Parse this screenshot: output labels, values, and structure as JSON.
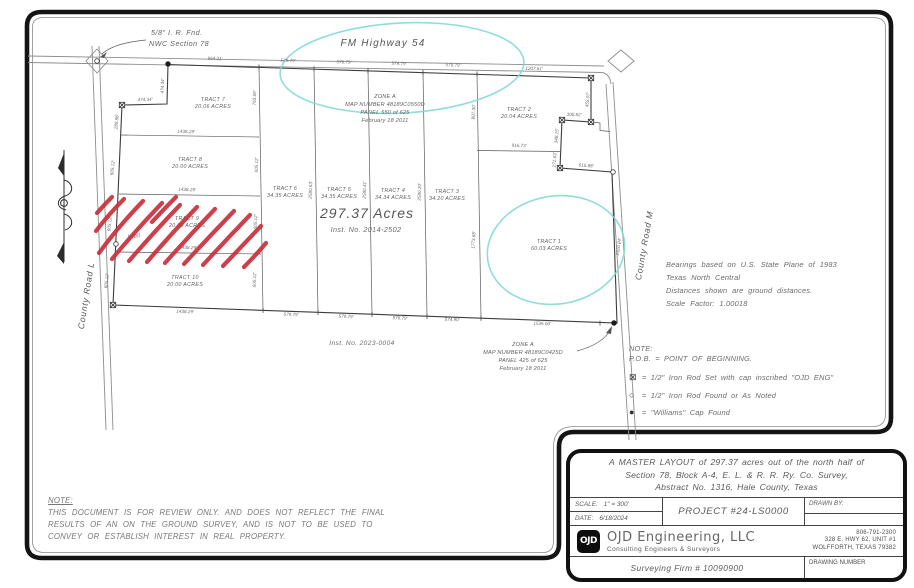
{
  "colors": {
    "linework": "#4a4a4a",
    "dim_text": "#6b6b6b",
    "hatch_red": "#c9303c",
    "highlight_cyan": "#7ed7d1",
    "frame_black": "#141414",
    "paper": "#ffffff"
  },
  "map": {
    "highway_label": "FM Highway 54",
    "corner_note": {
      "line1": "5/8\" I. R. Fnd.",
      "line2": "NWC Section 78"
    },
    "road_west": "County Road L",
    "road_east": "County Road M",
    "total_area": "297.37 Acres",
    "total_area_inst": "Inst. No. 2014-2502",
    "south_inst": "Inst. No. 2023-0004",
    "well_label": "Well",
    "zone_north": {
      "line1": "ZONE A",
      "line2": "MAP NUMBER 48189C0550D",
      "line3": "PANEL 550 of 625",
      "line4": "February 18 2011"
    },
    "zone_south": {
      "line1": "ZONE A",
      "line2": "MAP NUMBER 48189C0425D",
      "line3": "PANEL 425 of 625",
      "line4": "February 18 2011"
    },
    "tracts": [
      {
        "name": "TRACT 7",
        "acres": "20.06 ACRES"
      },
      {
        "name": "TRACT 8",
        "acres": "20.00 ACRES"
      },
      {
        "name": "TRACT 9",
        "acres": "20.00 ACRES"
      },
      {
        "name": "TRACT 10",
        "acres": "20.00 ACRES"
      },
      {
        "name": "TRACT 6",
        "acres": "34.35 ACRES"
      },
      {
        "name": "TRACT 5",
        "acres": "34.35 ACRES"
      },
      {
        "name": "TRACT 4",
        "acres": "34.34 ACRES"
      },
      {
        "name": "TRACT 3",
        "acres": "34.20 ACRES"
      },
      {
        "name": "TRACT 2",
        "acres": "20.04 ACRES"
      },
      {
        "name": "TRACT 1",
        "acres": "60.03 ACRES"
      }
    ],
    "dims": [
      "964.21'",
      "579.79'",
      "579.79'",
      "579.79'",
      "579.79'",
      "1207.61'",
      "474.34'",
      "474.34'",
      "289.86'",
      "605.12'",
      "605.12'",
      "605.12'",
      "1438.29'",
      "1438.29'",
      "1438.29'",
      "1438.29'",
      "763.69'",
      "605.12'",
      "605.12'",
      "605.12'",
      "2580.63'",
      "2580.41'",
      "2580.20'",
      "807.30'",
      "1773.68'",
      "455.07'",
      "300.82'",
      "348.15'",
      "916.73'",
      "271.63'",
      "615.88'",
      "1920.84'",
      "579.79'",
      "579.79'",
      "579.79'",
      "574.90'",
      "1535.00'"
    ]
  },
  "notes": {
    "bearings": {
      "line1": "Bearings based on U.S. State Plane of 1983",
      "line2": "Texas North Central",
      "line3": "Distances shown are ground distances.",
      "line4": "Scale Factor: 1.00018"
    },
    "legend": {
      "title": "NOTE:",
      "pob": "P.O.B. = POINT OF BEGINNING.",
      "items": [
        {
          "symbol": "⊠",
          "text": "= 1/2\" Iron Rod Set with cap inscribed \"OJD ENG\""
        },
        {
          "symbol": "○",
          "text": "= 1/2\" Iron Rod Found or As Noted"
        },
        {
          "symbol": "●",
          "text": "= \"Williams\" Cap Found"
        }
      ]
    },
    "review": {
      "title": "NOTE:",
      "line1": "THIS DOCUMENT IS FOR REVIEW ONLY. AND DOES NOT REFLECT THE FINAL",
      "line2": "RESULTS OF AN ON THE GROUND SURVEY, AND IS NOT TO BE USED TO",
      "line3": "CONVEY OR ESTABLISH INTEREST IN REAL PROPERTY."
    }
  },
  "title_block": {
    "description": {
      "line1": "A MASTER LAYOUT of 297.37 acres out of the north half of",
      "line2": "Section 78, Block A-4, E. L. & R. R. Ry. Co. Survey,",
      "line3": "Abstract No. 1316, Hale County, Texas"
    },
    "scale_label": "SCALE:",
    "scale_value": "1\" = 300'",
    "date_label": "DATE:",
    "date_value": "6/18/2024",
    "project": "PROJECT #24-LS0000",
    "drawn_by_label": "DRAWN BY:",
    "logo_text": "OJD",
    "company_name": "OJD Engineering, LLC",
    "company_tagline": "Consulting Engineers & Surveyors",
    "phone": "806-791-2300",
    "address_line1": "328 E. HWY 62, UNIT #1",
    "address_line2": "WOLFFORTH, TEXAS 79382",
    "firm": "Surveying Firm # 10090900",
    "drawing_number_label": "DRAWING NUMBER"
  }
}
